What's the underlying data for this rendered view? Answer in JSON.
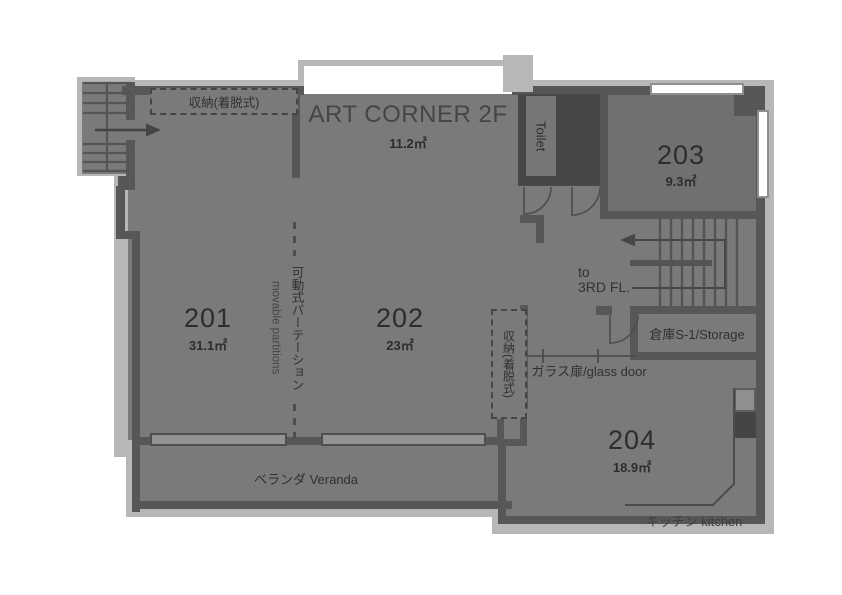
{
  "art_corner": {
    "name": "ART CORNER 2F",
    "area": "11.2㎡"
  },
  "rooms": [
    {
      "number": "201",
      "area": "31.1㎡"
    },
    {
      "number": "202",
      "area": "23㎡"
    },
    {
      "number": "203",
      "area": "9.3㎡"
    },
    {
      "number": "204",
      "area": "18.9㎡"
    }
  ],
  "labels": {
    "toilet": "Toilet",
    "storage": "倉庫S-1/Storage",
    "kitchen": "キッチン kitchen",
    "veranda": "ベランダ Veranda",
    "glass_door": "ガラス扉/glass door",
    "closet_top": "収納(着脱式)",
    "closet_side": "収納(着脱式)",
    "partition_jp": "可動式パーテーション",
    "partition_en": "movable partitions",
    "stairs_to": "to",
    "stairs_floor": "3RD FL."
  },
  "colors": {
    "wall": "#575757",
    "floor": "#7a7a7a",
    "outline": "#b7b7b7",
    "dark_block": "#474747",
    "white_room": "#ffffff",
    "window_bar": "#939393",
    "text": "#2d2d2d"
  }
}
